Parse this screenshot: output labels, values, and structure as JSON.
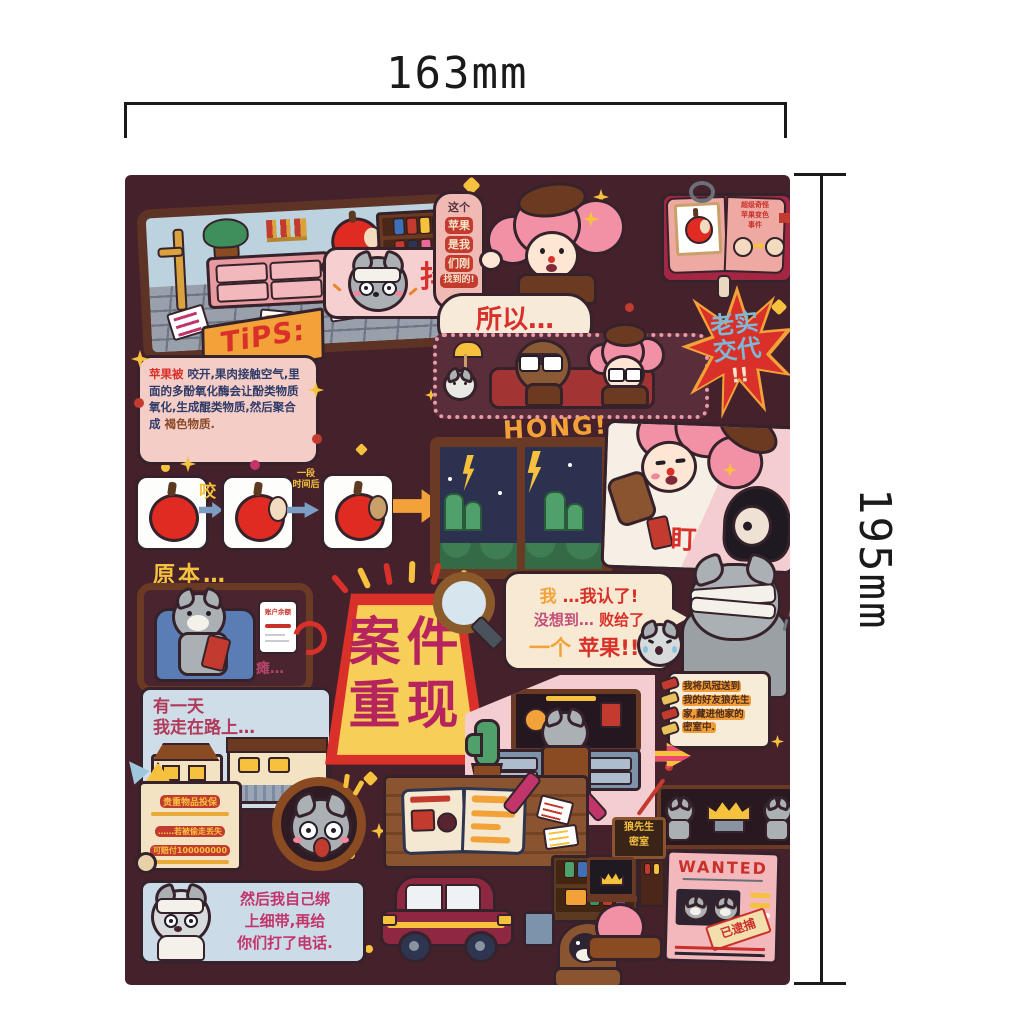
{
  "annotation": {
    "width_label": "163mm",
    "height_label": "195mm"
  },
  "colors": {
    "sheet_bg": "#45212b",
    "accent_red": "#d9302a",
    "accent_yellow": "#f6c23e",
    "accent_orange": "#f2a238",
    "magenta": "#b5245c",
    "panel_pink": "#f3cdd0"
  },
  "top": {
    "found_bubble": {
      "l1": "这个",
      "l2": "苹果",
      "l3": "是我",
      "l4": "们刚",
      "l5": "找到的!"
    },
    "shake_label": "抖",
    "book_note": {
      "l1": "超级奇怪",
      "l2": "苹果变色",
      "l3": "事件"
    }
  },
  "tips": {
    "title": "TiPS:",
    "lead": "苹果被",
    "body": "咬开,果肉接触空气,里面的多酚氧化酶会让酚类物质氧化,生成醌类物质,然后聚合成",
    "tail": "褐色物质."
  },
  "interrogation": {
    "so": "所以…",
    "demand_l1": "老实",
    "demand_l2": "交代",
    "demand_bang": "!!"
  },
  "apple_steps": {
    "bite": "咬",
    "after_l1": "一段",
    "after_l2": "时间后"
  },
  "flashback": {
    "hong": "HONG!",
    "stare": "盯"
  },
  "phone_scene": {
    "originally": "原本…",
    "slump": "瘫…",
    "balance": "账户余额"
  },
  "one_day": {
    "l1": "有一天",
    "l2": "我走在路上…"
  },
  "case_sign": {
    "c1": "案",
    "c2": "件",
    "c3": "重",
    "c4": "现"
  },
  "confession": {
    "p1a": "我",
    "p1b": "…我认了!",
    "p2a": "没想到…",
    "p2b": "败给了",
    "p3a": "一个",
    "p3b": "苹果!!!"
  },
  "diary": {
    "l1": "我将凤冠送到",
    "l2": "我的好友狼先生",
    "l3": "家,藏进他家的",
    "l4": "密室中."
  },
  "insurance": {
    "title": "贵重物品投保",
    "l2": "……若被偷走丢失",
    "l3": "可赔付100000000"
  },
  "then_panel": {
    "l1": "然后我自己绑",
    "l2": "上细带,再给",
    "l3": "你们打了电话."
  },
  "wolf_room": {
    "sign_l1": "狼先生",
    "sign_l2": "密室"
  },
  "wanted": {
    "title": "WANTED",
    "stamp": "已逮捕"
  }
}
